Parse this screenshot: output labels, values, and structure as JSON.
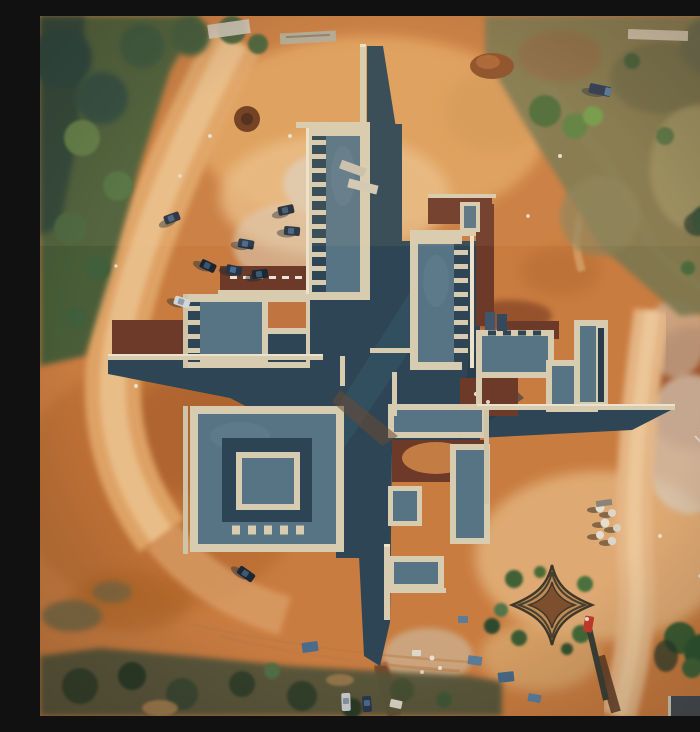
{
  "meta": {
    "scene_type": "aerial drone photograph",
    "aria_label": "Aerial top-down drone photo of a pinwheel-shaped building complex under construction on orange earth, surrounded by scrub vegetation, parked cars, construction materials, a star-shaped planter and a red crane truck",
    "time_of_day": "late afternoon warm light",
    "location_character": "construction site cleared from bushland"
  },
  "palette": {
    "dirt_base": "#c97c40",
    "dirt_light": "#e3a967",
    "dirt_pale": "#ecc491",
    "dirt_dark": "#a85f2d",
    "dirt_redbrown": "#9a5026",
    "plaza_shadow": "#2d4554",
    "roof_slate": "#577484",
    "wall_cream": "#d8ccb0",
    "wall_coping": "#ece2cc",
    "terrace_maroon": "#6d3929",
    "veg_dark_green": "#3d5a36",
    "veg_teal_shade": "#23413b",
    "veg_olive": "#7c7750",
    "veg_bottom_strip": "#55543a",
    "car_dark": "#1c2836",
    "car_white": "#d3d6d8",
    "crane_red": "#c23a2a",
    "tarp_blue": "#5b7d98",
    "star_planter_sand": "#c08a55"
  },
  "inventory": {
    "building": {
      "shape": "four-arm pinwheel / cross",
      "wings": [
        "north-wing",
        "northeast-wing",
        "east-wing",
        "southeast-wing",
        "south-spine",
        "southwest-compound",
        "northwest-compound"
      ],
      "features": [
        "slate grey flat roofs",
        "cream parapet walls",
        "dark shaded plazas",
        "maroon terraces",
        "thin tip walls extending N E S W"
      ]
    },
    "vehicles": {
      "parked_cars_northwest": 8,
      "white_car_west": 1,
      "car_southwest": 1,
      "cars_bottom_center": 2,
      "truck_top": 1,
      "crane_truck_bottom_right": 1
    },
    "details": [
      "star-shaped planter",
      "gravel piles",
      "material stacks",
      "blue tarps",
      "dirt roads",
      "tree clumps",
      "corner shed"
    ]
  }
}
